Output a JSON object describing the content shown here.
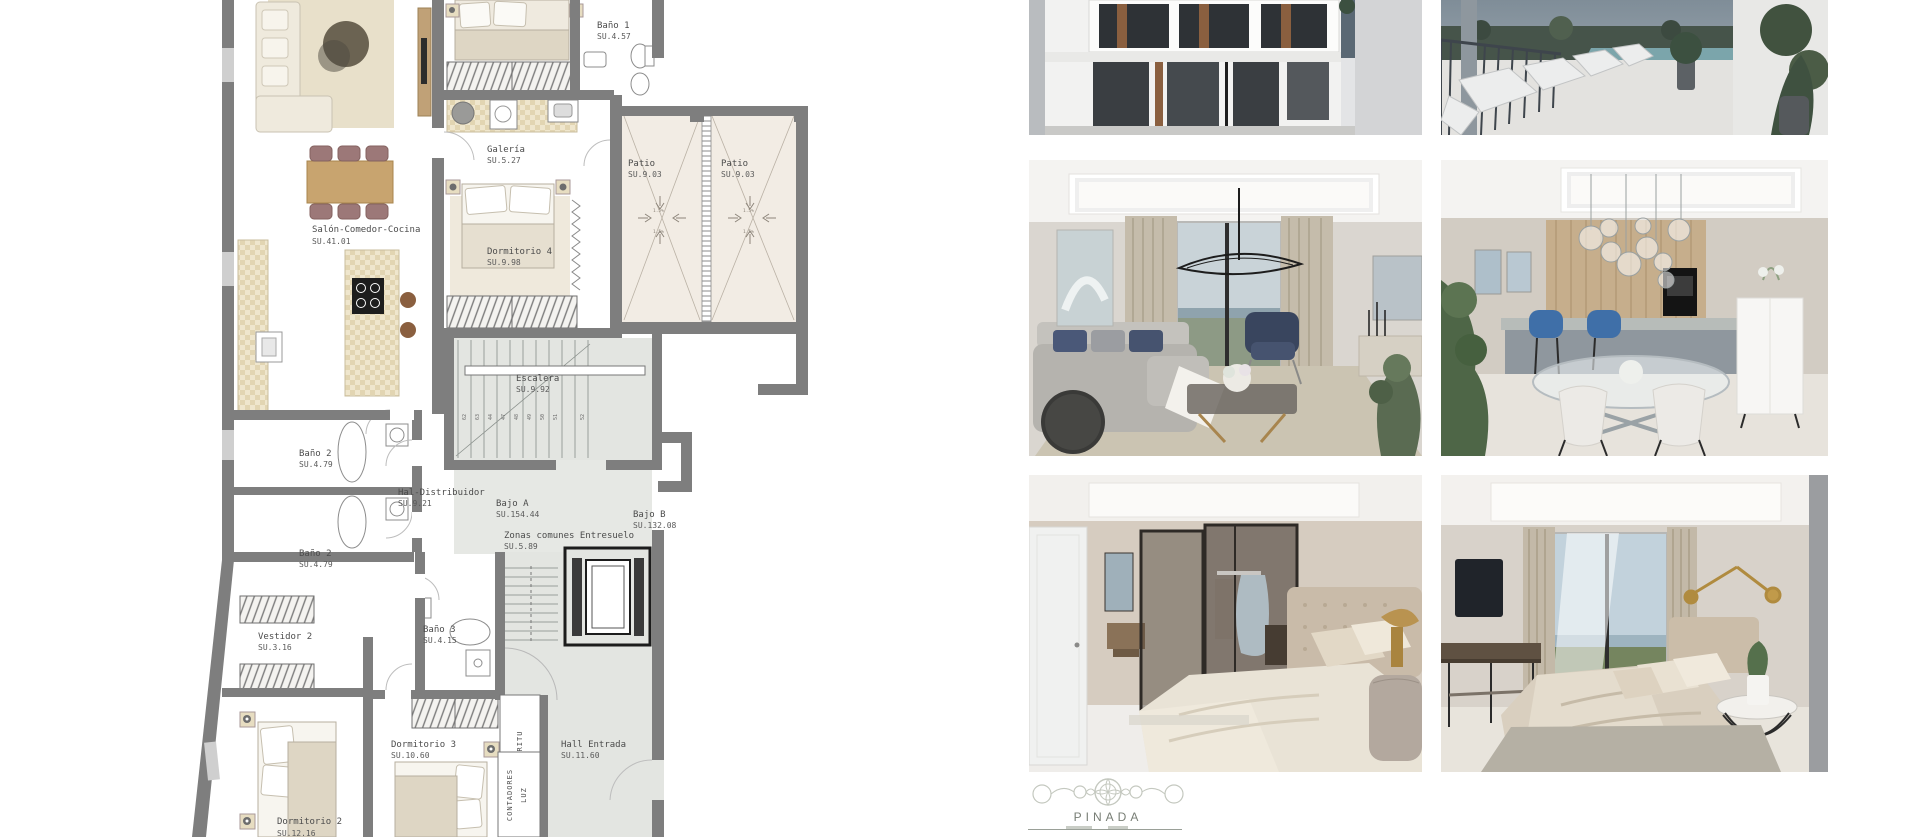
{
  "floorplan": {
    "rooms": [
      {
        "name": "Salón-Comedor-Cocina",
        "area": "SU.41.01"
      },
      {
        "name": "Galería",
        "area": "SU.5.27"
      },
      {
        "name": "Baño 1",
        "area": "SU.4.57"
      },
      {
        "name": "Patio",
        "area": "SU.9.03"
      },
      {
        "name": "Patio",
        "area": "SU.9.03"
      },
      {
        "name": "Dormitorio 4",
        "area": "SU.9.98"
      },
      {
        "name": "Escalera",
        "area": "SU.9.92"
      },
      {
        "name": "Baño 2",
        "area": "SU.4.79"
      },
      {
        "name": "Baño 2",
        "area": "SU.4.79"
      },
      {
        "name": "Hal-Distribuidor",
        "area": "SU.9.21"
      },
      {
        "name": "Bajo A",
        "area": "SU.154.44"
      },
      {
        "name": "Bajo B",
        "area": "SU.132.08"
      },
      {
        "name": "Zonas comunes Entresuelo",
        "area": "SU.5.89"
      },
      {
        "name": "Vestidor 2",
        "area": "SU.3.16"
      },
      {
        "name": "Baño 3",
        "area": "SU.4.15"
      },
      {
        "name": "Dormitorio 3",
        "area": "SU.10.60"
      },
      {
        "name": "Hall Entrada",
        "area": "SU.11.60"
      },
      {
        "name": "Dormitorio 2",
        "area": "SU.12.16"
      }
    ],
    "utilities": {
      "ritu": "RITU",
      "contadores": "CONTADORES",
      "luz": "LUZ"
    },
    "slope_label": "1.5%",
    "stair_steps": [
      "61",
      "62",
      "63",
      "44",
      "47",
      "48",
      "49",
      "50",
      "51",
      "52"
    ],
    "colors": {
      "wall": "#7e7e7e",
      "common_floor": "#e3e5e1",
      "patio_floor": "#f2ece4"
    }
  },
  "gallery": {
    "photos": [
      {
        "name": "exterior-facade-render"
      },
      {
        "name": "roof-terrace-pool-render"
      },
      {
        "name": "living-room-render"
      },
      {
        "name": "dining-kitchen-render"
      },
      {
        "name": "bedroom-ensuite-render"
      },
      {
        "name": "bedroom-view-render"
      }
    ]
  },
  "brand": {
    "name": "PINADA"
  }
}
